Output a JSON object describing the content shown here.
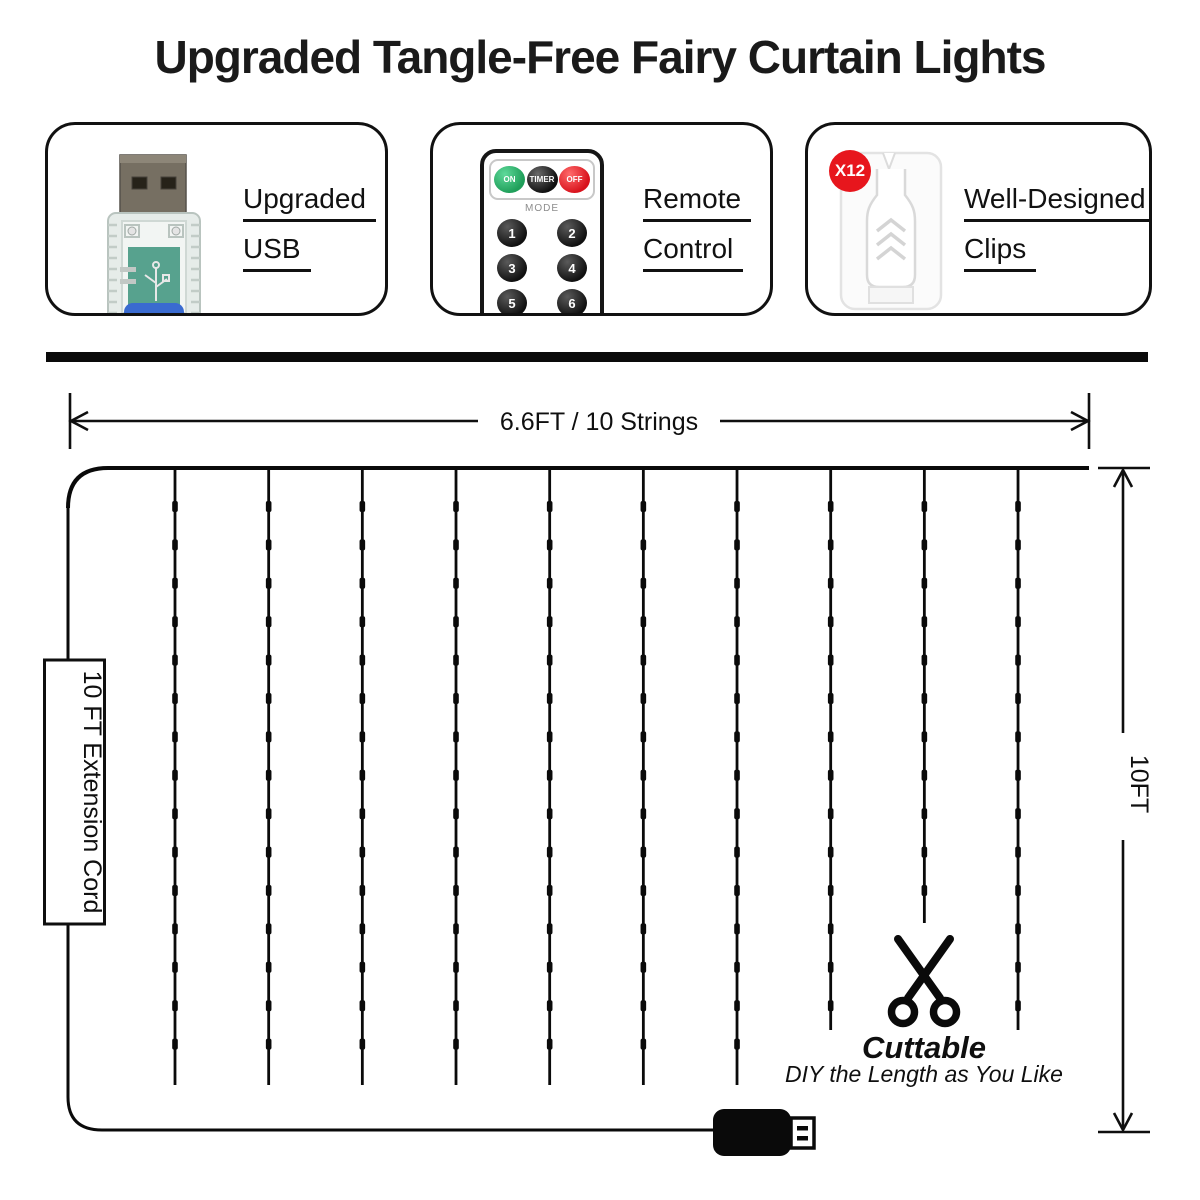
{
  "title": "Upgraded Tangle-Free Fairy Curtain Lights",
  "features": [
    {
      "line1": "Upgraded",
      "line2": "USB",
      "image": "usb-plug-photo"
    },
    {
      "line1": "Remote",
      "line2": "Control",
      "image": "remote-control-photo"
    },
    {
      "line1": "Well-Designed",
      "line2": "Clips",
      "image": "clip-photo",
      "badge": "X12"
    }
  ],
  "remote": {
    "on_label": "ON",
    "timer_label": "TIMER",
    "off_label": "OFF",
    "mode_label": "MODE",
    "buttons": [
      "1",
      "2",
      "3",
      "4",
      "5",
      "6",
      "7",
      "8"
    ]
  },
  "diagram": {
    "width_label": "6.6FT / 10 Strings",
    "height_label": "10FT",
    "cord_label": "10 FT Extension Cord",
    "cuttable_title": "Cuttable",
    "cuttable_note": "DIY the Length as You Like",
    "num_strings": 10
  },
  "colors": {
    "ink": "#0a0a0a",
    "badge_red": "#e7161d",
    "on_green": "#1f9e59",
    "off_red": "#d8121c",
    "pcb_green": "#57a28e",
    "usb_blue": "#3a6bd0"
  }
}
